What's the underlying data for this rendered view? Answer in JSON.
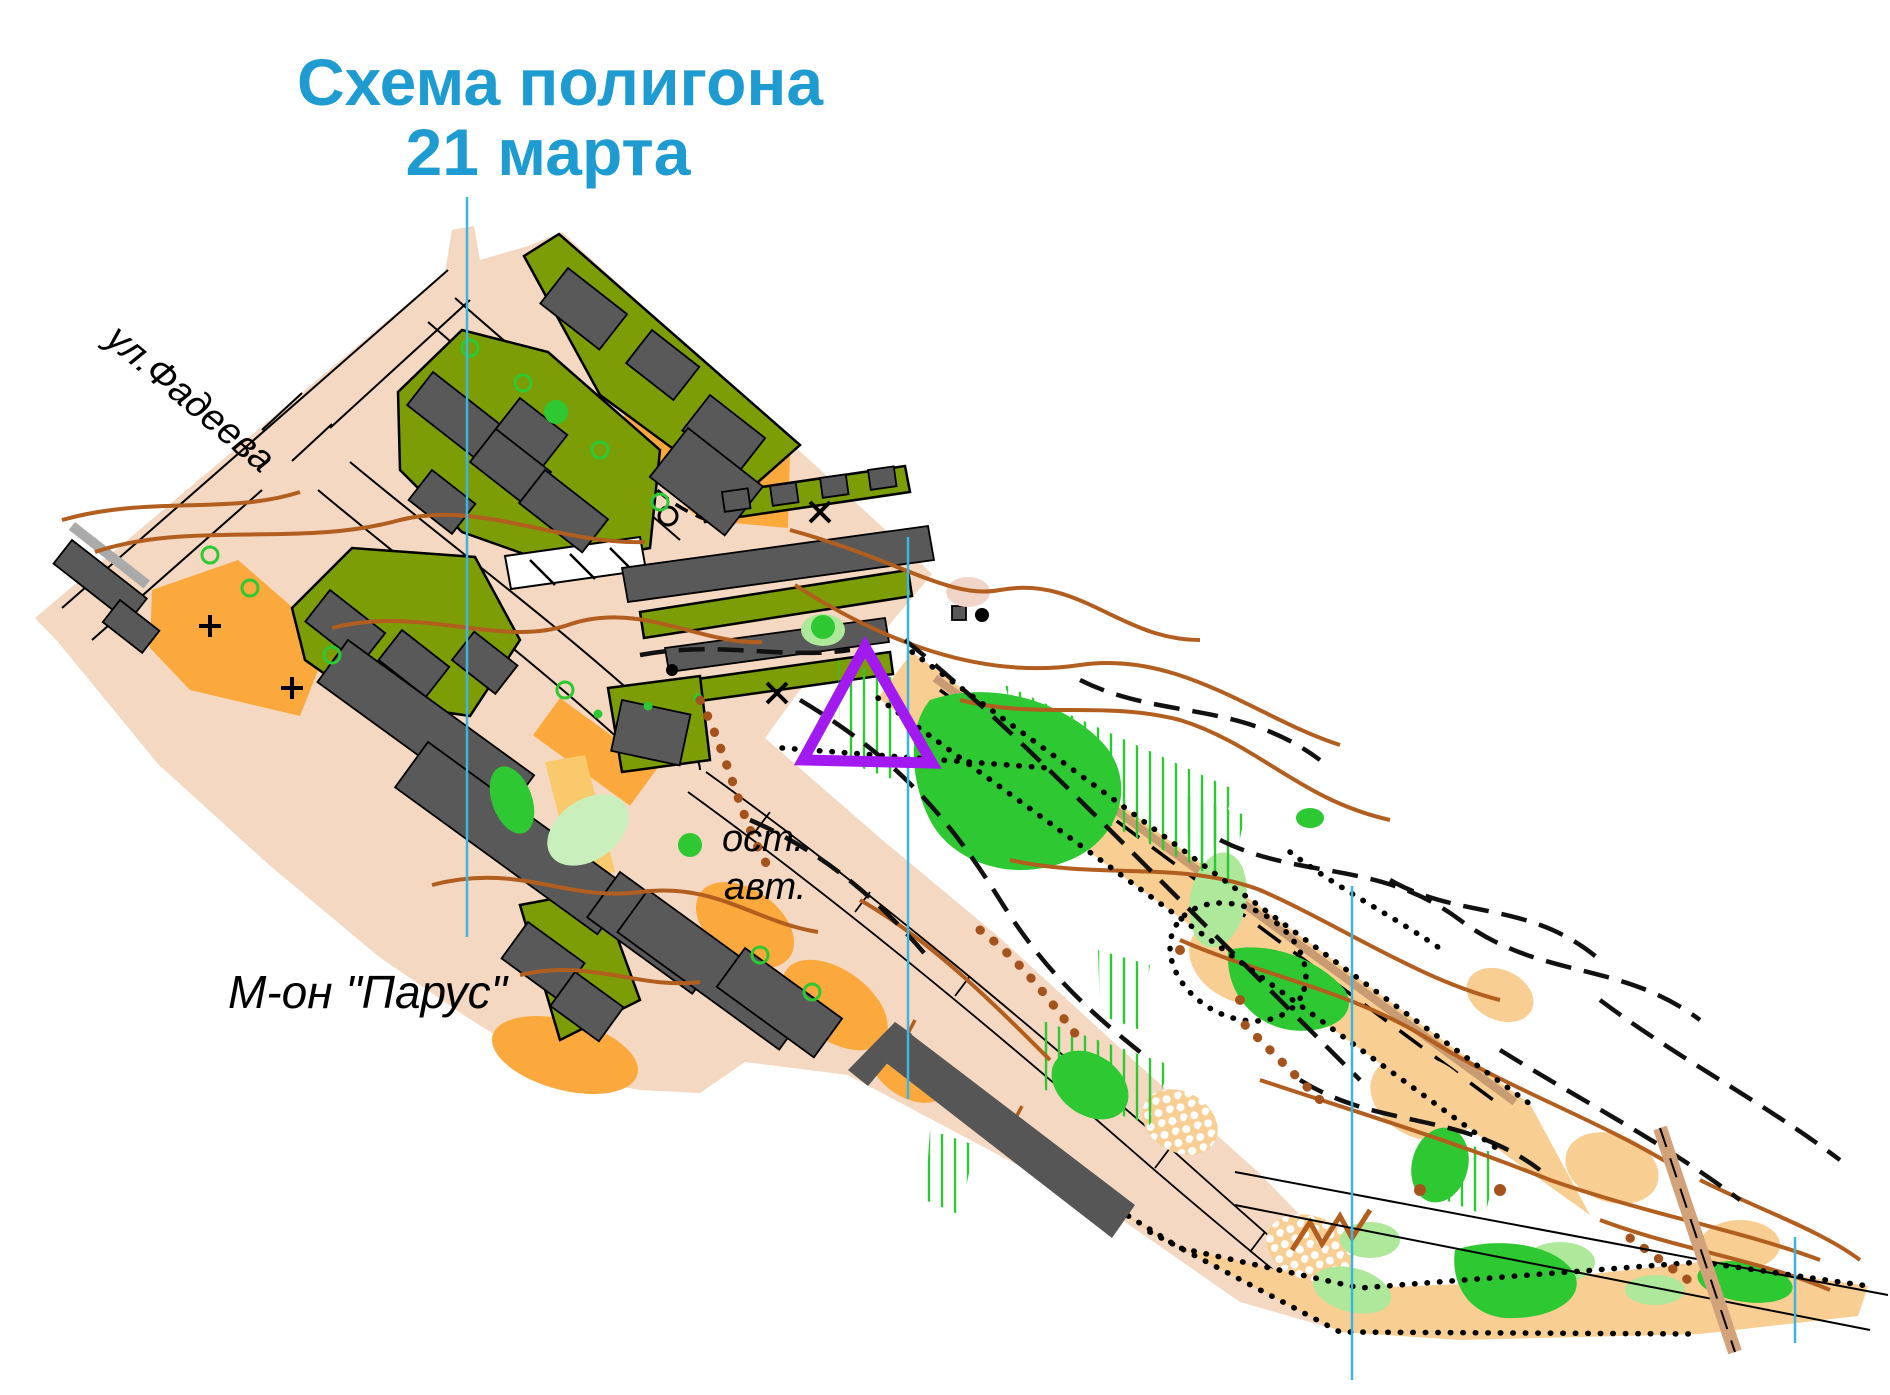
{
  "title": {
    "line1": "Схема полигона",
    "line2": "21 марта",
    "color": "#1E9CD2"
  },
  "labels": {
    "street": "ул.Фадеева",
    "bus_stop_line1": "ост.",
    "bus_stop_line2": "авт.",
    "district": "М-он \"Парус\""
  },
  "map": {
    "kind": "orienteering training polygon map",
    "start_symbol": "purple start triangle",
    "start_triangle_color": "#A21AF0",
    "north_line_color": "#3FB4DE",
    "colors": {
      "paved_area": "#F4D8C1",
      "forbidden_yard_olive": "#7C9D06",
      "building_gray": "#595959",
      "open_land_orange": "#FBA93C",
      "open_land_yellow": "#F9C96B",
      "sand_open": "#F8CE92",
      "vegetation_green": "#2EC832",
      "vegetation_light_green": "#AEE89B",
      "contour_brown": "#B25E1E",
      "dark_structure": "#565656"
    }
  }
}
